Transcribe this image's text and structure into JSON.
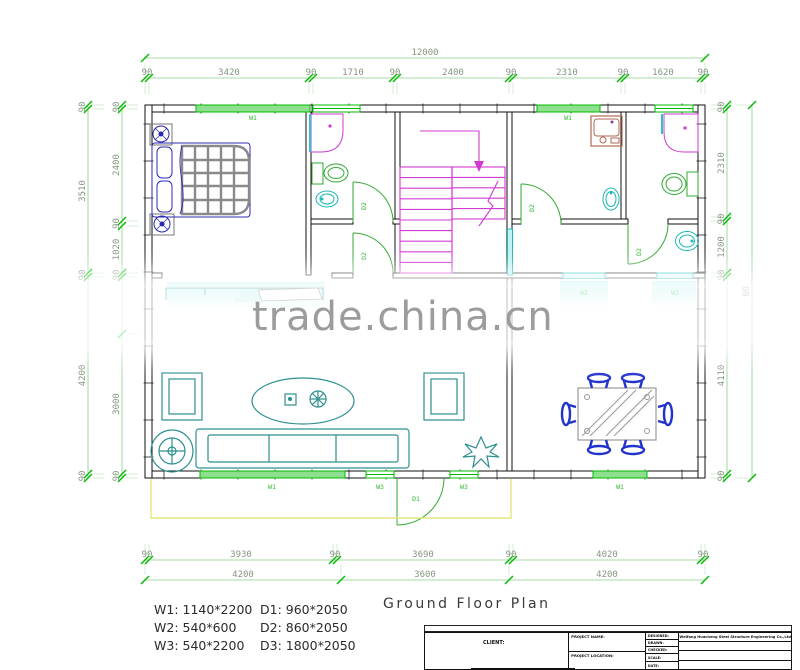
{
  "watermark": {
    "text": "trade.china.cn",
    "color": "#9c9c9c"
  },
  "title": "Ground Floor Plan",
  "legend": {
    "windows": [
      "W1: 1140*2200",
      "W2: 540*600",
      "W3: 540*2200"
    ],
    "doors": [
      "D1: 960*2050",
      "D2: 860*2050",
      "D3: 1800*2050"
    ]
  },
  "dimensions": {
    "top_total": "12000",
    "top_segments": [
      "90",
      "3420",
      "90",
      "1710",
      "90",
      "2400",
      "90",
      "2310",
      "90",
      "1620",
      "90"
    ],
    "left_outer": [
      "90",
      "3510",
      "90",
      "4200",
      "90"
    ],
    "left_inner": [
      "90",
      "2400",
      "90",
      "1020",
      "90",
      "",
      "3000",
      "90"
    ],
    "right_inner": [
      "90",
      "2310",
      "90",
      "1200",
      "90",
      "4110",
      "90"
    ],
    "right_outer_total": "80",
    "bottom_row1": [
      "90",
      "3930",
      "90",
      "3690",
      "90",
      "4020",
      "90"
    ],
    "bottom_row2": [
      "4200",
      "3600",
      "4200"
    ]
  },
  "plan_labels": [
    "W1",
    "W1",
    "W1",
    "W3",
    "W3",
    "W1",
    "W2",
    "W2",
    "D2",
    "D2",
    "D2",
    "D2",
    "D1"
  ],
  "titleblock": {
    "client": "CLIENT:",
    "project_name": "PROJECT NAME:",
    "project_location": "PROJECT LOCATION:",
    "designed": "DESIGNED:",
    "drawn": "DRAWN:",
    "checked": "CHECKED:",
    "scale": "SCALE:",
    "date": "DATE:",
    "company": "Weifang Huacheng Steel Structure Engineering Co.,Ltd"
  },
  "colors": {
    "wall": "#111111",
    "dimension_tick_green": "#00bb00",
    "dimension_text": "#85967f",
    "window_green": "#00cc00",
    "fixture_cyan": "#1db8b8",
    "stair_magenta": "#d23bd2",
    "furniture_teal": "#2d8f8f",
    "chair_blue": "#2233cc",
    "porch_yellow": "#e6e67a"
  }
}
